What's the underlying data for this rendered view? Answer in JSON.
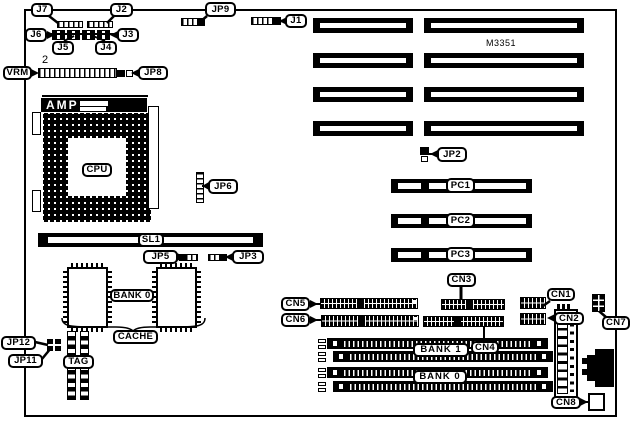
{
  "board": {
    "model": "M3351",
    "vrm_pin1": "2"
  },
  "labels": {
    "j1": "J1",
    "j2": "J2",
    "j3": "J3",
    "j4": "J4",
    "j5": "J5",
    "j6": "J6",
    "j7": "J7",
    "jp2": "JP2",
    "jp3": "JP3",
    "jp5": "JP5",
    "jp6": "JP6",
    "jp8": "JP8",
    "jp9": "JP9",
    "jp11": "JP11",
    "jp12": "JP12",
    "cn1": "CN1",
    "cn2": "CN2",
    "cn3": "CN3",
    "cn4": "CN4",
    "cn5": "CN5",
    "cn6": "CN6",
    "cn7": "CN7",
    "cn8": "CN8",
    "vrm": "VRM",
    "amp": "AMP",
    "cpu": "CPU",
    "sl1": "SL1",
    "pc1": "PC1",
    "pc2": "PC2",
    "pc3": "PC3",
    "cache_bank": "BANK 0",
    "cache": "CACHE",
    "tag": "TAG",
    "bank1": "BANK 1",
    "bank0": "BANK 0"
  }
}
